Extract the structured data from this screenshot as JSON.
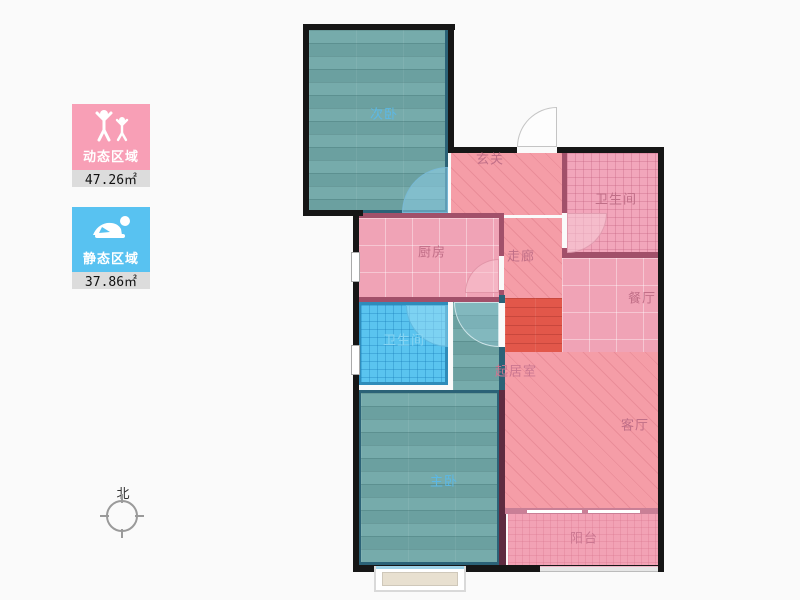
{
  "legend": {
    "dynamic": {
      "label": "动态区域",
      "area": "47.26㎡",
      "color": "#f89fb6"
    },
    "static": {
      "label": "静态区域",
      "area": "37.86㎡",
      "color": "#58c2f1"
    }
  },
  "compass": {
    "label": "北"
  },
  "rooms": {
    "bedroom2": {
      "label": "次卧"
    },
    "entry": {
      "label": "玄关"
    },
    "bath_main": {
      "label": "卫生间"
    },
    "kitchen": {
      "label": "厨房"
    },
    "corridor": {
      "label": "走廊"
    },
    "dining": {
      "label": "餐厅"
    },
    "bath_second": {
      "label": "卫生间"
    },
    "living_core": {
      "label": "起居室"
    },
    "living": {
      "label": "客厅"
    },
    "master": {
      "label": "主卧"
    },
    "balcony": {
      "label": "阳台"
    }
  },
  "colors": {
    "wall": "#161616",
    "inner_wall": "#a2506a",
    "teal_floor": "#6fa7a7",
    "pink_floor": "#f59da7",
    "blue_tile": "#5ac4ef",
    "red_patch": "#e2574a",
    "label_blue": "#5cb8e6",
    "label_pink": "#c06e87"
  }
}
